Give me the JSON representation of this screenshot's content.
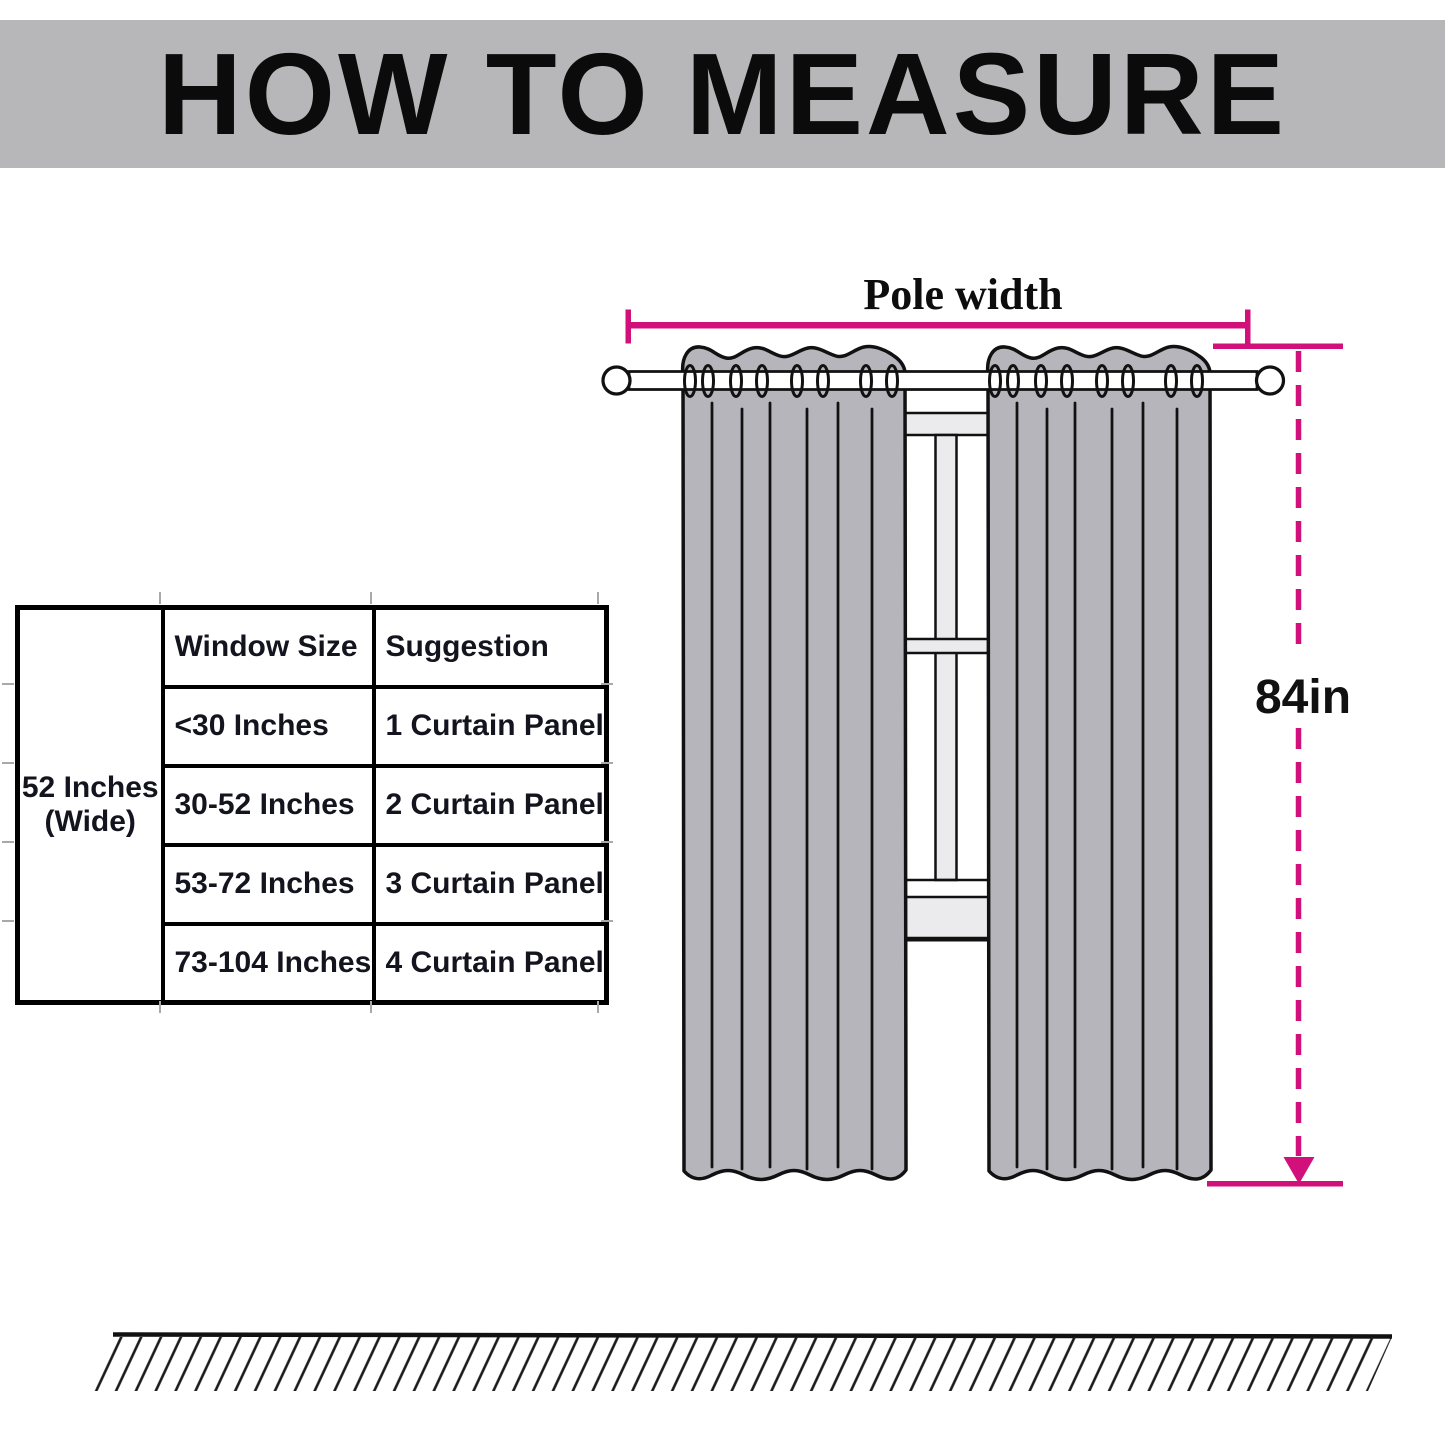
{
  "header": {
    "title": "HOW TO MEASURE"
  },
  "size_table": {
    "width_label": {
      "line1": "52 Inches",
      "line2": "(Wide)"
    },
    "columns": {
      "window_size": "Window Size",
      "suggestion": "Suggestion"
    },
    "rows": [
      {
        "window_size": "<30 Inches",
        "suggestion": "1 Curtain Panel"
      },
      {
        "window_size": "30-52 Inches",
        "suggestion": "2 Curtain Panel"
      },
      {
        "window_size": "53-72 Inches",
        "suggestion": "3 Curtain Panel"
      },
      {
        "window_size": "73-104 Inches",
        "suggestion": "4 Curtain Panel"
      }
    ]
  },
  "diagram": {
    "pole_width_label": "Pole width",
    "height_label": "84in",
    "colors": {
      "accent": "#d1107c",
      "curtain": "#b5b5bb",
      "header_bar": "#b7b7b9",
      "frame_light": "#ebebed"
    }
  }
}
